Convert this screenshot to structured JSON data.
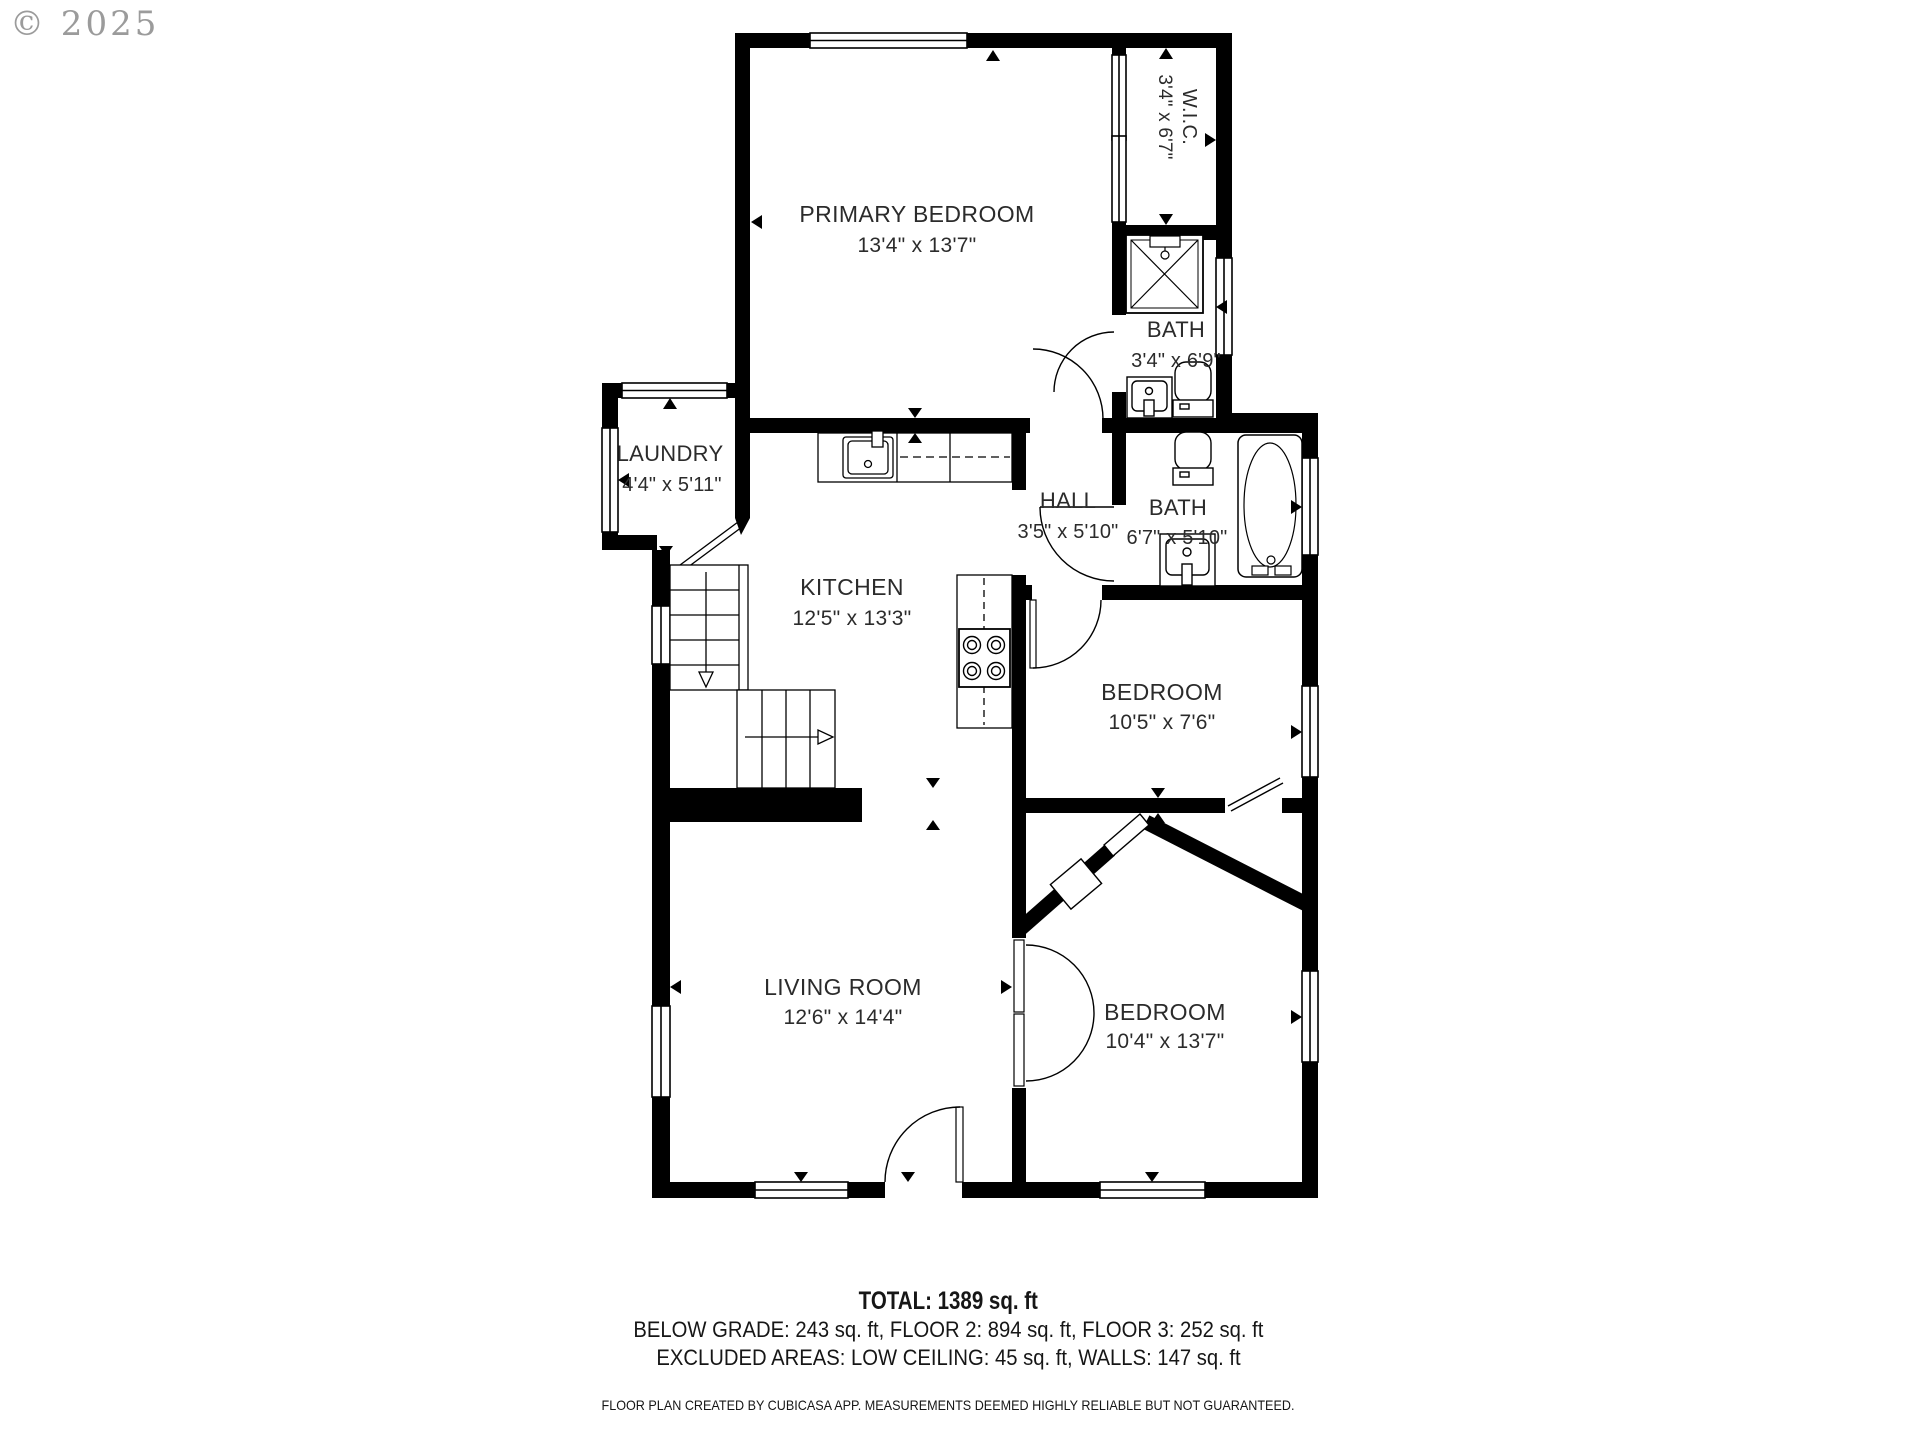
{
  "watermark": "© 2025",
  "rooms": [
    {
      "name": "PRIMARY BEDROOM",
      "dims": "13'4\" x 13'7\""
    },
    {
      "name": "W.I.C.",
      "dims": "3'4\" x 6'7\""
    },
    {
      "name": "BATH",
      "dims": "3'4\" x 6'9\""
    },
    {
      "name": "LAUNDRY",
      "dims": "4'4\" x 5'11\""
    },
    {
      "name": "HALL",
      "dims": "3'5\" x 5'10\""
    },
    {
      "name": "BATH",
      "dims": "6'7\" x 5'10\""
    },
    {
      "name": "KITCHEN",
      "dims": "12'5\" x 13'3\""
    },
    {
      "name": "BEDROOM",
      "dims": "10'5\" x 7'6\""
    },
    {
      "name": "LIVING ROOM",
      "dims": "12'6\" x 14'4\""
    },
    {
      "name": "BEDROOM",
      "dims": "10'4\" x 13'7\""
    }
  ],
  "summary": {
    "total": "TOTAL: 1389 sq. ft",
    "line2": "BELOW GRADE: 243 sq. ft, FLOOR 2: 894 sq. ft, FLOOR 3: 252 sq. ft",
    "line3": "EXCLUDED AREAS: LOW CEILING: 45 sq. ft, WALLS: 147 sq. ft",
    "disclaimer": "FLOOR PLAN CREATED BY CUBICASA APP. MEASUREMENTS DEEMED HIGHLY RELIABLE BUT NOT GUARANTEED."
  },
  "colors": {
    "wall": "#000000",
    "text": "#2b2b2b",
    "watermark": "#8a8a8a",
    "background": "#ffffff"
  }
}
